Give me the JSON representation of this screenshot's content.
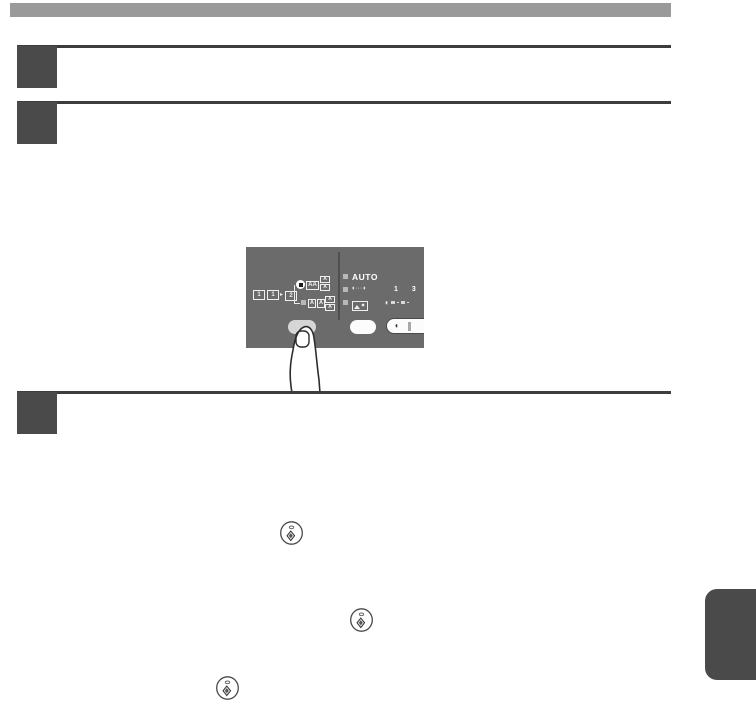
{
  "page": {
    "background": "#ffffff",
    "top_bar_color": "#9a9a9a",
    "rule_color": "#3d3d3d",
    "step_square_color": "#4a4a4a",
    "side_tab_color": "#4a4a4a"
  },
  "steps": [
    {
      "id": "step-1"
    },
    {
      "id": "step-2"
    },
    {
      "id": "step-3"
    }
  ],
  "panel": {
    "bg_color": "#6b6b6b",
    "originals": [
      "1",
      "1",
      "2"
    ],
    "arrow": "▸",
    "top_row_box": "AA",
    "top_stack": [
      "A",
      "A"
    ],
    "bottom_row_boxes": [
      "A",
      "A"
    ],
    "bottom_stack": [
      "A",
      "A"
    ],
    "auto_label": "AUTO",
    "contrast_icon_glyphs": "◖···◗",
    "exposure_numbers": "1 3",
    "exposure_left_glyph": "◖",
    "right_button_glyph": "◖"
  },
  "icons": {
    "start_key": "start-key-diamond-circle",
    "photo_mode": "photo-mode-icon",
    "finger": "pressing-finger-illustration"
  }
}
